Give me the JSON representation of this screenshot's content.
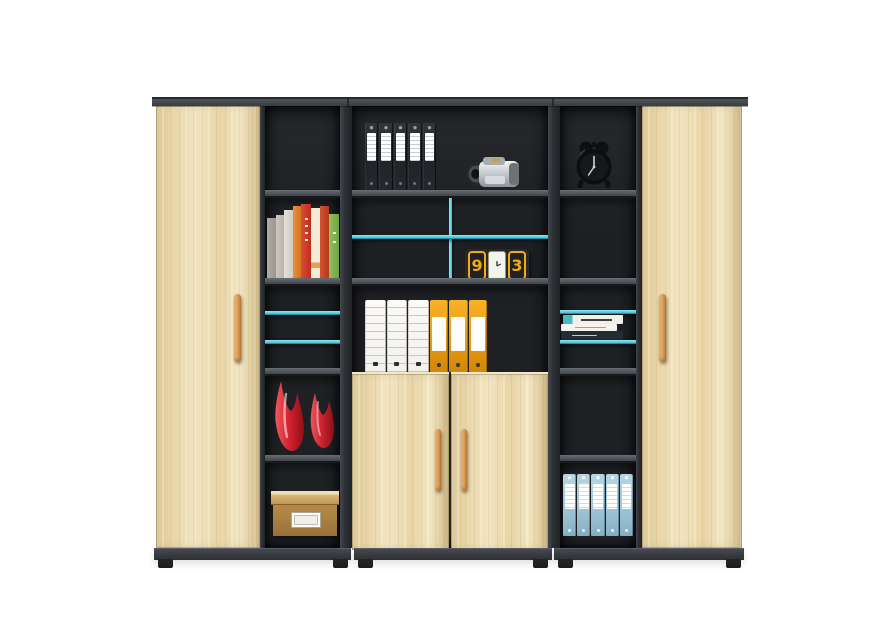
{
  "scene": {
    "type": "product-photo",
    "subject": "Modern office storage cabinet combination: two tall light-maple doors flanking open dark shelving units with teal glass accent shelves, a two-door maple lower cabinet in the middle, shown on a plain white studio background",
    "colors": {
      "background": "#ffffff",
      "wood": "#e8d5a6",
      "wood-light": "#f2e5c2",
      "wood-dark": "#d8c28e",
      "frame": "#3e4248",
      "frame-dark": "#27292d",
      "interior": "#1f2125",
      "shelf-face": "#5a5f66",
      "base": "#35383d",
      "foot": "#232528",
      "accent-cyan": "#3ec2d6",
      "accent-cyan-light": "#8fe7f2",
      "accent-cyan-dark": "#1f93a6",
      "handle": "#e2a65c",
      "handle-dark": "#c2823a",
      "binder-black": "#25282c",
      "binder-white": "#f2f1ed",
      "binder-orange": "#eea11c",
      "binder-blue": "#a2c8da",
      "box-tan": "#b98f4e",
      "vase-red": "#d6242f",
      "clock-yellow": "#f2ab10",
      "clock-body": "#28282b"
    },
    "cabinet": {
      "sections": [
        "left tall maple door",
        "left open shelf column",
        "center open shelving with lower two-door maple cabinet",
        "right open shelf column",
        "right tall maple door"
      ],
      "handles": "vertical light-wood bar handles",
      "accents": "teal/cyan glass shelf edges and one vertical teal divider"
    },
    "objects": {
      "black_binders": {
        "count": 5,
        "location": "center unit, top shelf left"
      },
      "camcorder": {
        "count": 1,
        "color": "silver",
        "location": "center unit, top shelf right"
      },
      "desk_clock": {
        "left_digit": "9",
        "right_digit": "3",
        "location": "center unit, second shelf right"
      },
      "white_binders": {
        "count": 3,
        "location": "center unit, third shelf"
      },
      "orange_binders": {
        "count": 3,
        "location": "center unit, third shelf"
      },
      "books": {
        "count": 8,
        "location": "left column, second shelf"
      },
      "red_vases": {
        "count": 2,
        "location": "left column, fourth shelf"
      },
      "storage_box": {
        "count": 1,
        "color": "tan with cream lid",
        "location": "left column, bottom shelf"
      },
      "alarm_clock": {
        "count": 1,
        "color": "black twin-bell",
        "location": "right column, top shelf"
      },
      "magazines": {
        "count": 3,
        "location": "right column, middle glass shelf"
      },
      "blue_binders": {
        "count": 5,
        "location": "right column, bottom shelf"
      }
    }
  }
}
